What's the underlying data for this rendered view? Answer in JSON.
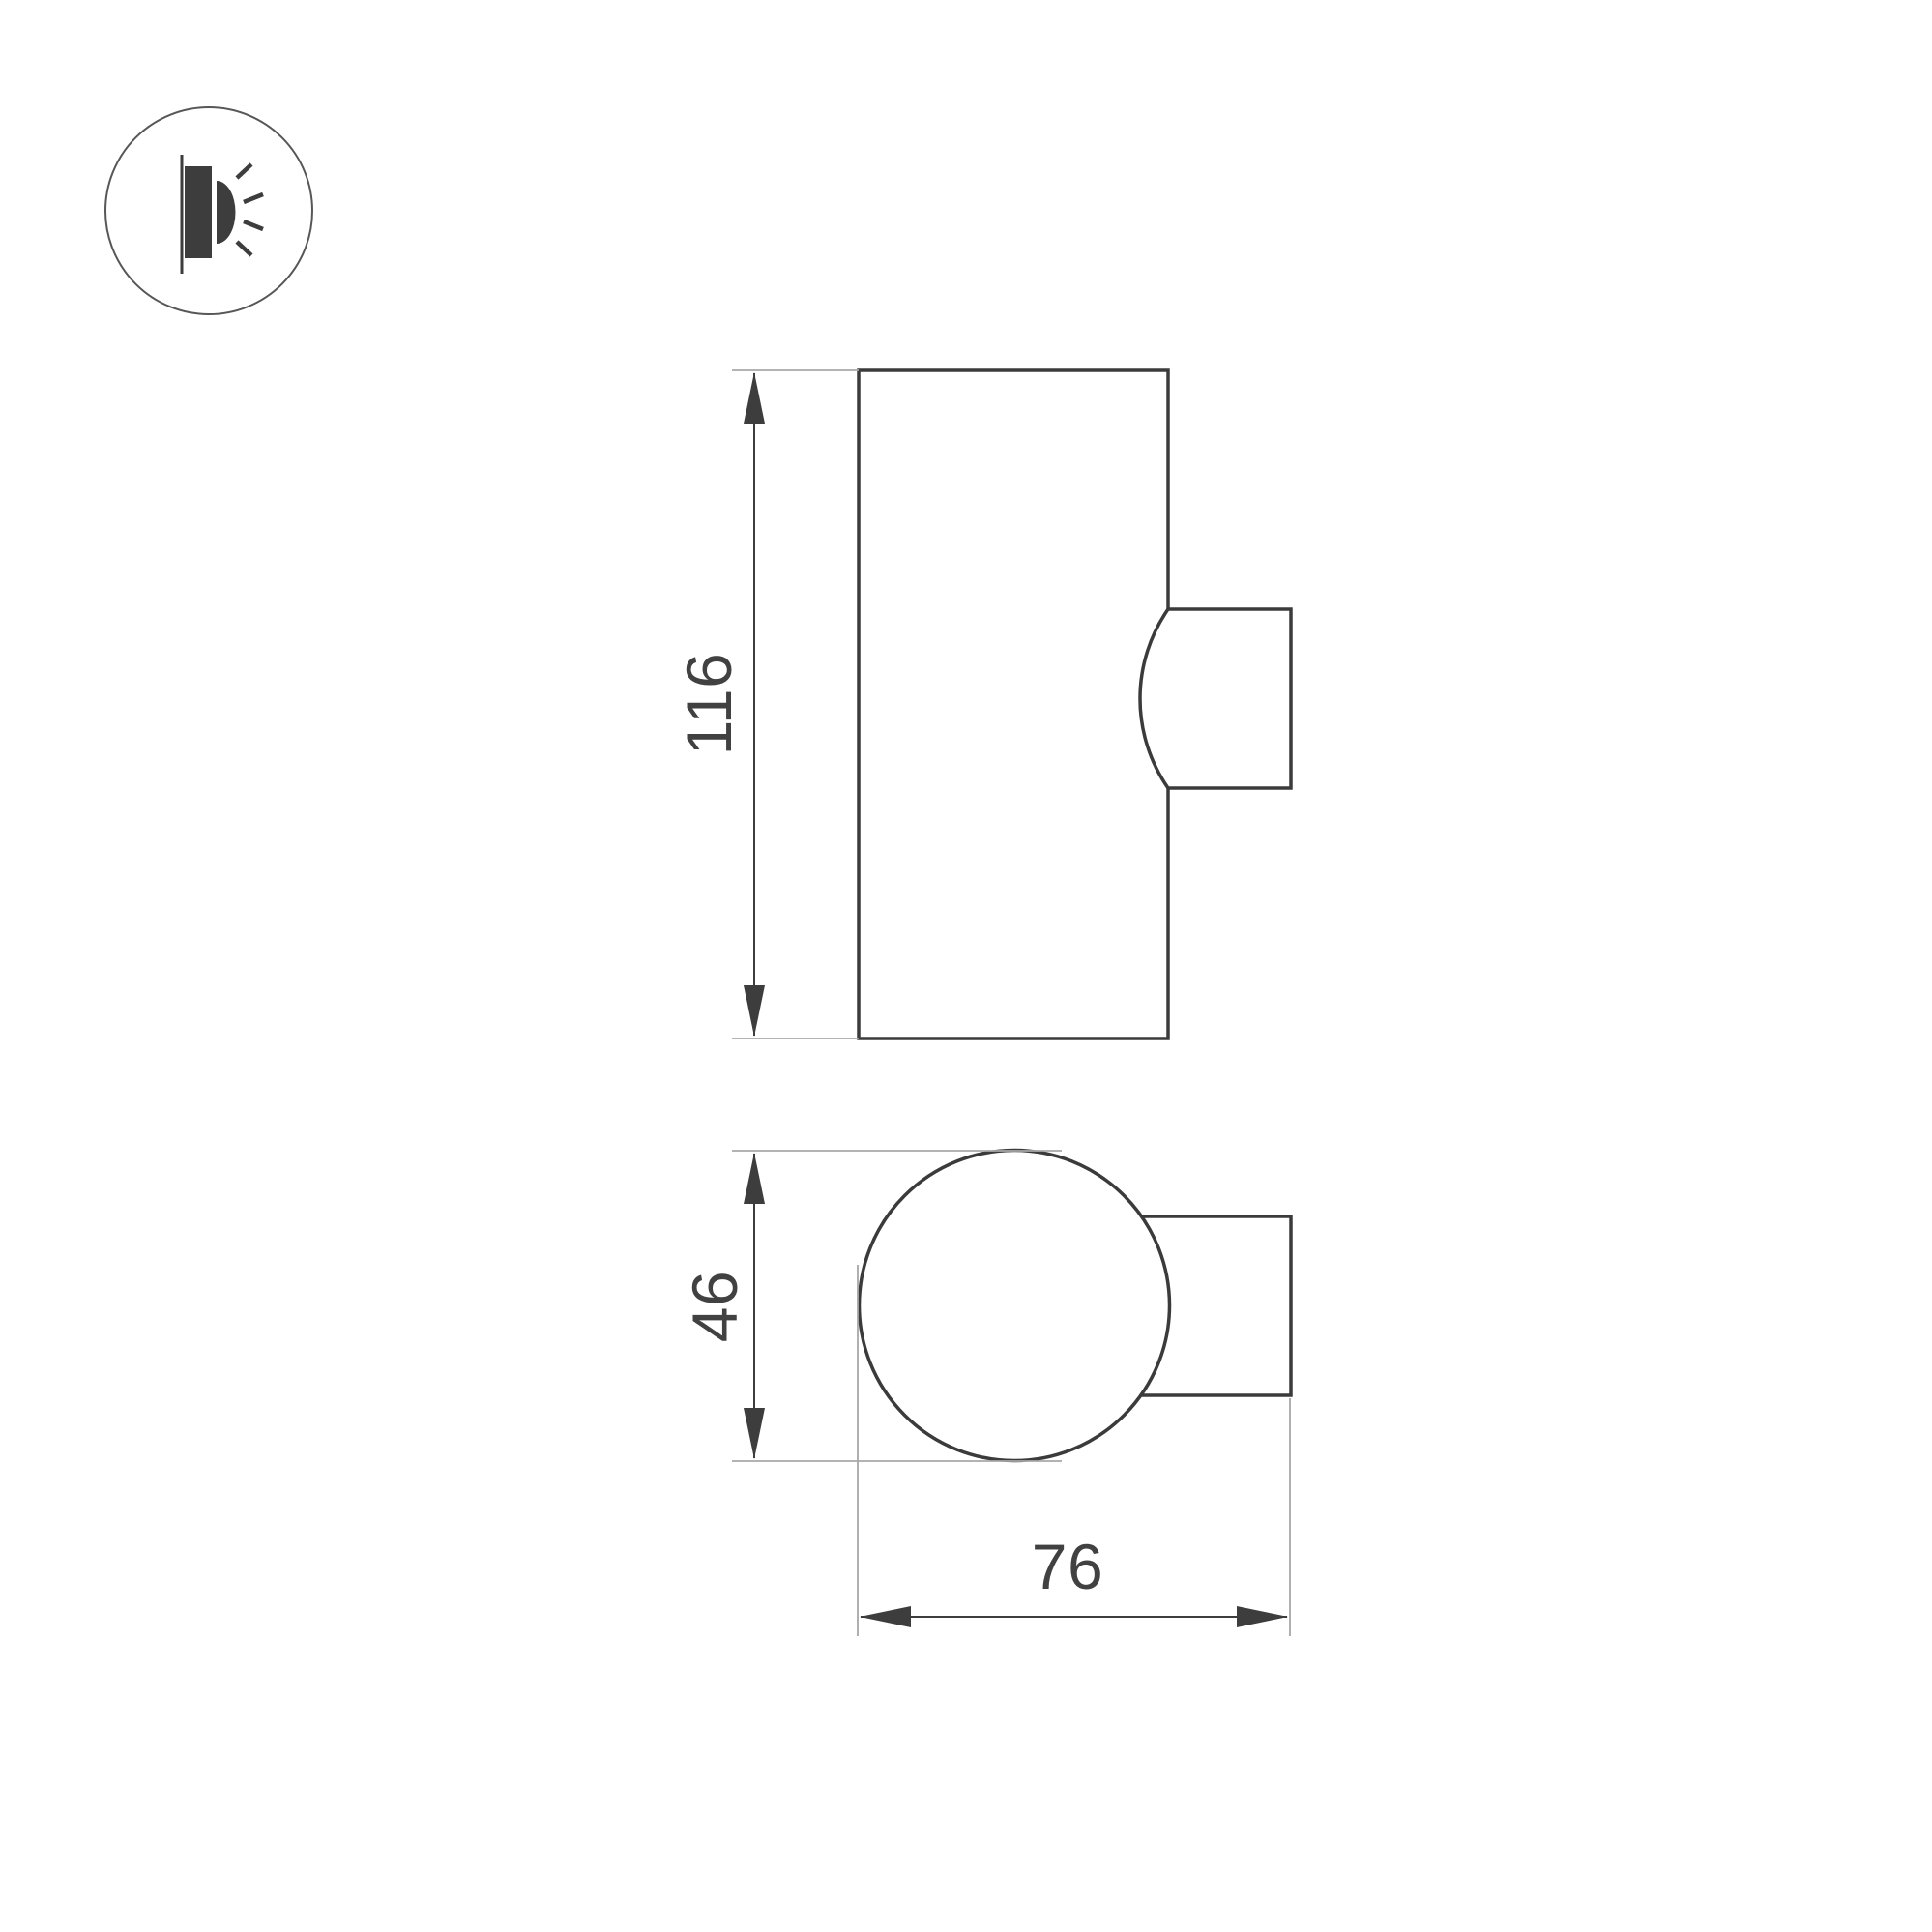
{
  "colors": {
    "background": "#ffffff",
    "outline": "#3b3b3b",
    "dimension": "#3d3d3d",
    "extension": "#a8a8a8",
    "label": "#414141",
    "icon_fill": "#3d3d3d",
    "icon_ring": "#575757"
  },
  "icon": {
    "name": "wall-mounted-light"
  },
  "dimensions": {
    "height": "116",
    "diameter": "46",
    "depth": "76"
  }
}
